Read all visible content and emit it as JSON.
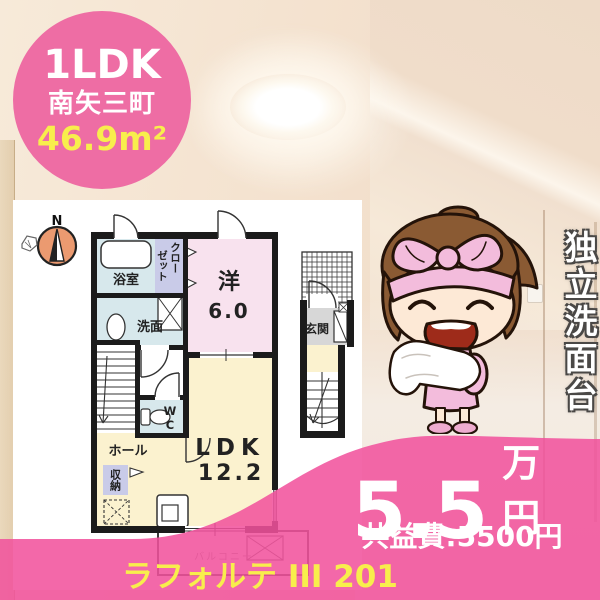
{
  "listing": {
    "badge": {
      "layout": "1LDK",
      "town": "南矢三町",
      "area": "46.9m²"
    },
    "feature_vertical": "独立洗面台",
    "price": {
      "rent": "5.5",
      "rent_unit": "万円",
      "common_fee": "共益費:5500円"
    },
    "building_name": "ラフォルテ III 201"
  },
  "floorplan": {
    "compass": "N",
    "rooms": {
      "bath": "浴室",
      "closet_lines": [
        "クロー",
        "ゼット"
      ],
      "western": "洋",
      "western_size": "6.0",
      "washroom": "洗面",
      "wc": "WC",
      "hall": "ホール",
      "storage": "収納",
      "ldk": "LDK",
      "ldk_size": "12.2",
      "entrance": "玄関",
      "balcony": "バルコニー"
    }
  },
  "colors": {
    "badge_pink": "#ee6da4",
    "wave_pink": "#f1519c",
    "accent_yellow": "#f8ee4c",
    "text_white": "#ffffff"
  }
}
